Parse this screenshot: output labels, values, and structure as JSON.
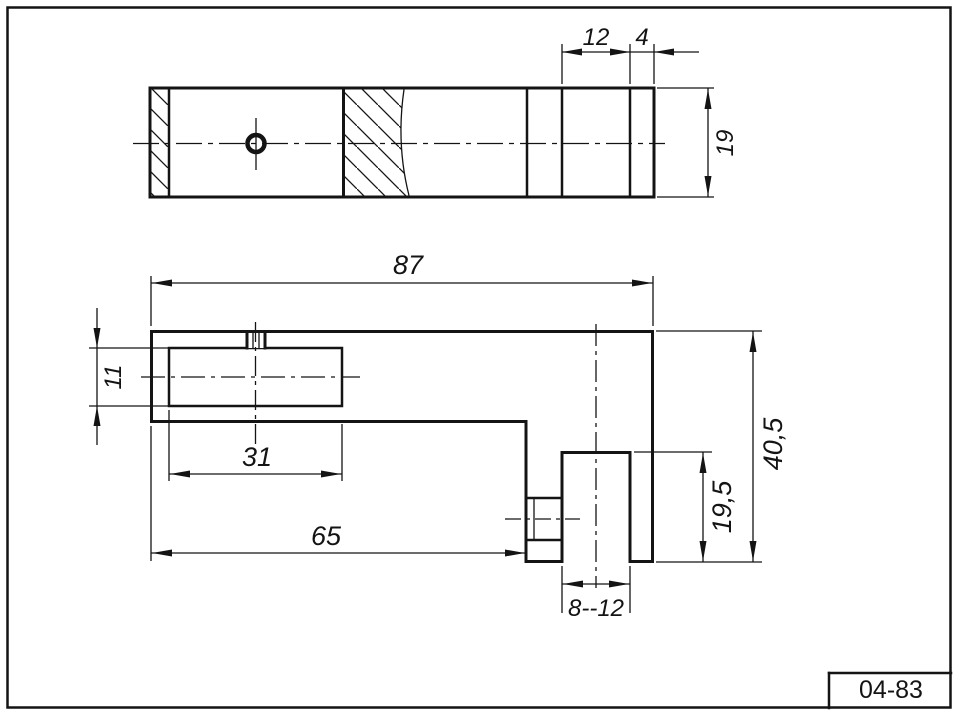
{
  "page": {
    "background_color": "#ffffff",
    "line_color": "#141414"
  },
  "title_block": {
    "drawing_number": "04-83"
  },
  "top_view": {
    "dim_hole_to_step": "12",
    "dim_end_wall": "4",
    "dim_height": "19"
  },
  "front_view": {
    "dim_overall_width": "87",
    "dim_slot_height": "11",
    "dim_slot_depth": "31",
    "dim_step_length": "65",
    "dim_leg_hole_height": "19,5",
    "dim_overall_height": "40,5",
    "dim_hole_width": "8--12"
  }
}
